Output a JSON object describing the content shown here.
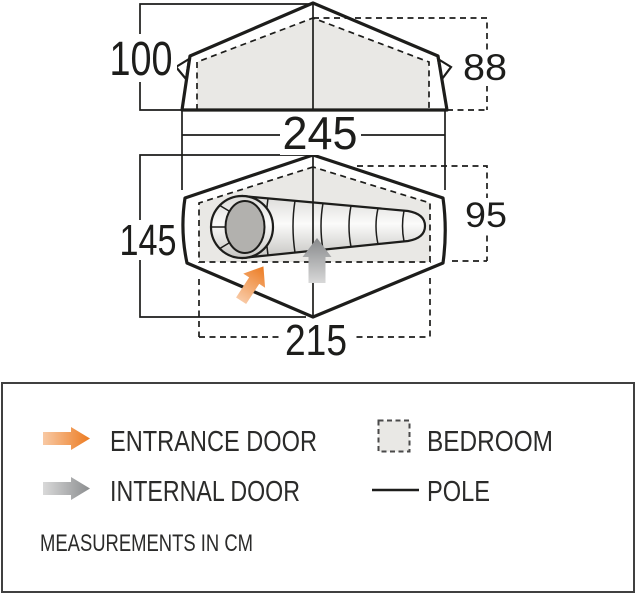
{
  "unit_note": "MEASUREMENTS IN CM",
  "side_view": {
    "height_left_cm": "100",
    "height_right_cm": "88",
    "length_cm": "245"
  },
  "floor_plan": {
    "width_cm": "145",
    "bedroom_width_cm": "95",
    "bedroom_length_cm": "215"
  },
  "legend": {
    "entrance_door": "ENTRANCE DOOR",
    "internal_door": "INTERNAL DOOR",
    "bedroom": "BEDROOM",
    "pole": "POLE"
  },
  "colors": {
    "accent_orange": "#ed7c22",
    "arrow_gray": "#8b8d8f",
    "bedroom_fill": "#e9e8e5",
    "line": "#1d1d1b"
  }
}
